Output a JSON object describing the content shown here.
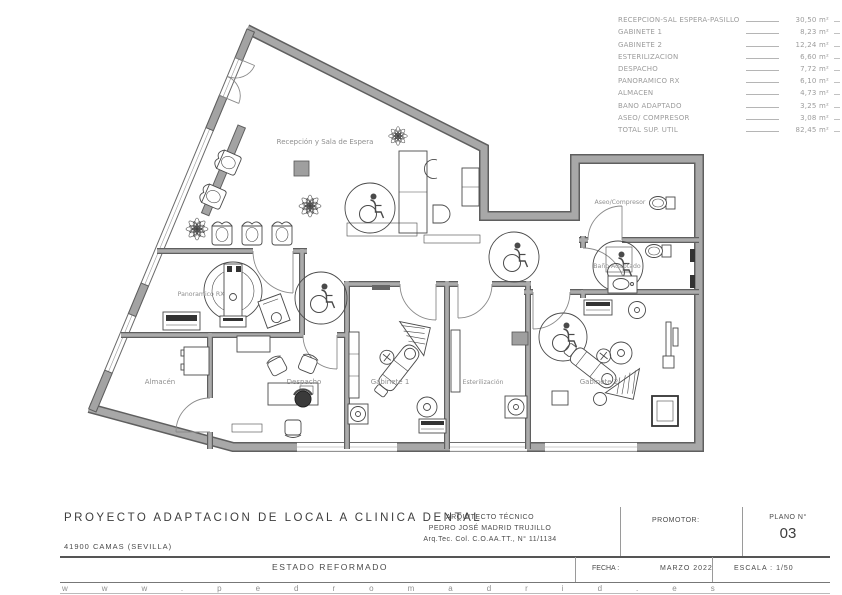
{
  "legend": {
    "items": [
      {
        "label": "RECEPCION-SAL ESPERA-PASILLO",
        "value": "30,50 m²"
      },
      {
        "label": "GABINETE 1",
        "value": "8,23 m²"
      },
      {
        "label": "GABINETE 2",
        "value": "12,24 m²"
      },
      {
        "label": "ESTERILIZACION",
        "value": "6,60 m²"
      },
      {
        "label": "DESPACHO",
        "value": "7,72 m²"
      },
      {
        "label": "PANORAMICO RX",
        "value": "6,10 m²"
      },
      {
        "label": "ALMACEN",
        "value": "4,73 m²"
      },
      {
        "label": "BAÑO ADAPTADO",
        "value": "3,25 m²"
      },
      {
        "label": "ASEO/ COMPRESOR",
        "value": "3,08 m²"
      },
      {
        "label": "TOTAL SUP. UTIL",
        "value": "82,45 m²"
      }
    ]
  },
  "plan": {
    "rooms": {
      "reception": "Recepción y Sala de Espera",
      "panoramico": "Panoramico RX",
      "almacen": "Almacén",
      "despacho": "Despacho",
      "gabinete1": "Gabinete 1",
      "esterilizacion": "Esterilización",
      "gabinete2": "Gabinete 2",
      "aseo": "Aseo/Compresor",
      "bano": "Baño Adaptado"
    }
  },
  "titleblock": {
    "project_title": "PROYECTO ADAPTACION DE LOCAL A CLINICA DENTAL",
    "location": "41900 CAMAS (SEVILLA)",
    "architect_heading": "ARQUITECTO TÉCNICO",
    "architect_name": "PEDRO JOSÉ MADRID TRUJILLO",
    "architect_credentials": "Arq.Tec. Col. C.O.AA.TT., N° 11/1134",
    "promoter_label": "PROMOTOR:",
    "plan_number_label": "PLANO N°",
    "plan_number": "03",
    "state_label": "ESTADO REFORMADO",
    "date_label": "FECHA :",
    "date_value": "MARZO 2022",
    "scale_label": "ESCALA : 1/50",
    "website": "www.pedromadrid.es"
  }
}
